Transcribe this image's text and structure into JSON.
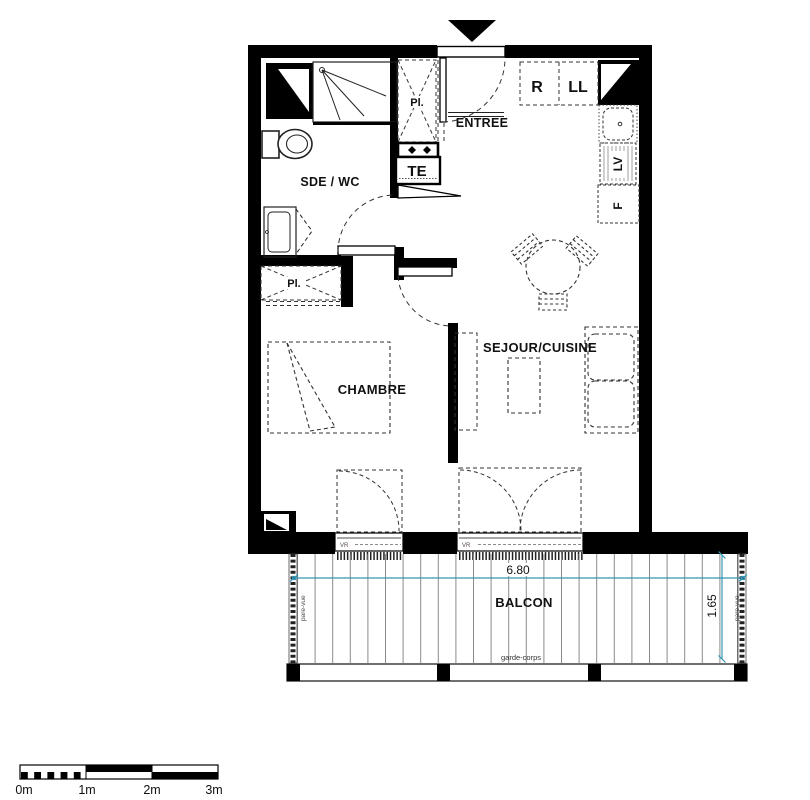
{
  "plan": {
    "rooms": {
      "sde_wc": "SDE / WC",
      "entree": "ENTREE",
      "chambre": "CHAMBRE",
      "sejour": "SEJOUR/CUISINE",
      "balcon": "BALCON"
    },
    "labels": {
      "pl_hall": "Pl.",
      "pl_chambre": "Pl.",
      "te": "TE",
      "r": "R",
      "ll": "LL",
      "lv": "LV",
      "f": "F",
      "vr_chambre": "VR",
      "vr_sejour": "VR"
    },
    "balcony": {
      "width": "6.80",
      "depth": "1.65",
      "pare_vue_left": "pare-vue",
      "pare_vue_right": "pare-vue",
      "garde_corps": "garde-corps"
    },
    "scale_bar": {
      "labels": [
        "0m",
        "1m",
        "2m",
        "3m"
      ]
    },
    "colors": {
      "dimension": "#3496b5",
      "wall": "#000000",
      "furniture": "#333333"
    }
  }
}
